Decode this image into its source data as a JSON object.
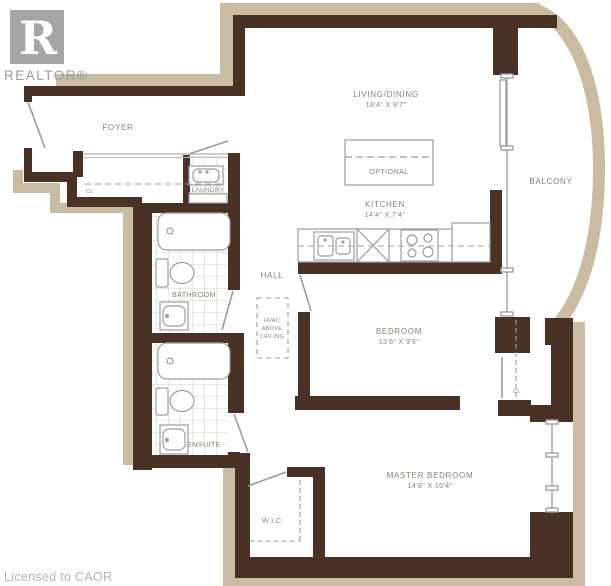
{
  "branding": {
    "logo_letter": "R",
    "logo_wordmark": "REALTOR®",
    "footer": "Licensed to CAOR"
  },
  "rooms": {
    "living_dining": {
      "name": "LIVING/DINING",
      "dims": "18'4\" X 9'7\""
    },
    "kitchen": {
      "name": "KITCHEN",
      "dims": "14'4\" X 7'4\""
    },
    "foyer": {
      "name": "FOYER"
    },
    "laundry": {
      "name": "LAUNDRY"
    },
    "bathroom": {
      "name": "BATHROOM"
    },
    "hall": {
      "name": "HALL"
    },
    "ensuite": {
      "name": "ENSUITE"
    },
    "bedroom": {
      "name": "BEDROOM",
      "dims": "13'6\" X 9'6\""
    },
    "master_bedroom": {
      "name": "MASTER BEDROOM",
      "dims": "14'8\" X 10'4\""
    },
    "balcony": {
      "name": "BALCONY"
    },
    "wic": {
      "name": "W.I.C."
    }
  },
  "annotations": {
    "optional_island": "OPTIONAL",
    "hvac_line1": "HVAC",
    "hvac_line2": "ABOVE",
    "hvac_line3": "CEILING",
    "closet_foyer": "CL",
    "closet_bedroom": "CL"
  },
  "colors": {
    "wall": "#4a3126",
    "exterior_band": "#c9bca2",
    "fixture_line": "#9c9c9c",
    "label_text": "#8d8174",
    "tile_line": "#d5d0c4",
    "logo_gray": "#a5a5a5",
    "footer_text": "#b5b5b5"
  }
}
